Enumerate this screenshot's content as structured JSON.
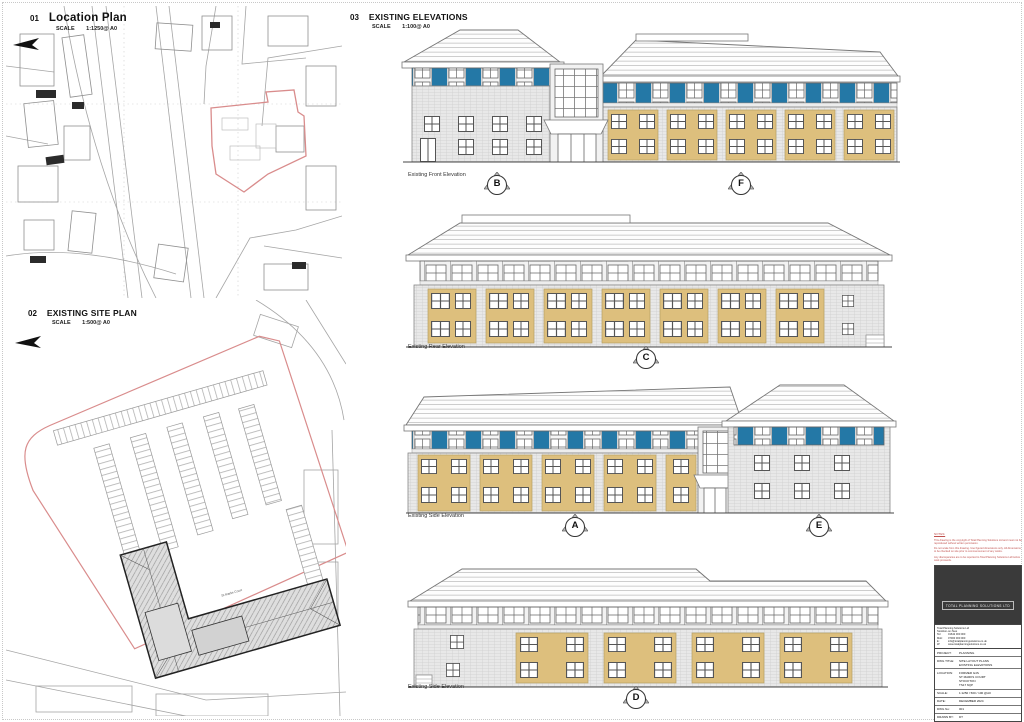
{
  "panels": {
    "location_plan": {
      "number": "01",
      "title": "Location Plan",
      "scale_label": "SCALE",
      "scale_value": "1:1250@ A0"
    },
    "site_plan": {
      "number": "02",
      "title": "EXISTING SITE PLAN",
      "scale_label": "SCALE",
      "scale_value": "1:500@ A0",
      "building_label": "St Marks Court"
    },
    "elevations": {
      "number": "03",
      "title": "EXISTING ELEVATIONS",
      "scale_label": "SCALE",
      "scale_value": "1:100@ A0",
      "items": [
        {
          "label": "Existing Front Elevation",
          "markers": [
            "B",
            "F"
          ]
        },
        {
          "label": "Existing Rear Elevation",
          "markers": [
            "C"
          ]
        },
        {
          "label": "Existing Side Elevation",
          "markers": [
            "A",
            "E"
          ]
        },
        {
          "label": "Existing Side Elevation",
          "markers": [
            "D"
          ]
        }
      ]
    }
  },
  "title_block": {
    "notes_heading": "NOTES:",
    "notes": [
      "This drawing is the copyright of Total Planning Solutions Ltd and must not be reproduced without written permission.",
      "Do not scale from this drawing. Use figured dimensions only. All dimensions to be checked on site prior to commencement of any works.",
      "Any discrepancies are to be reported to Total Planning Solutions Ltd before work proceeds."
    ],
    "company": "TOTAL PLANNING SOLUTIONS LTD",
    "contact": {
      "line1": "Total Planning Solutions Ltd",
      "line2": "Stockton-on-Tees",
      "tel_label": "Tel:",
      "tel": "01642 000 000",
      "mob_label": "Mob:",
      "mob": "07000 000 000",
      "email_label": "E:",
      "email": "info@totalplanningsolutions.co.uk",
      "web_label": "W:",
      "web": "www.totalplanningsolutions.co.uk"
    },
    "rows": {
      "project": {
        "label": "PROJECT:",
        "value": "PLANNING"
      },
      "dwg_title": {
        "label": "DWG TITLE:",
        "lines": [
          "SITE LAYOUT PLANS",
          "EXISTING ELEVATIONS"
        ]
      },
      "location": {
        "label": "LOCATION:",
        "lines": [
          "FORMER G4S",
          "ST MARKS COURT",
          "STOCKTON",
          "TS17 6QP"
        ]
      },
      "scale": {
        "label": "SCALE:",
        "value": "1:1250 / 500 / 100 @A0"
      },
      "date": {
        "label": "DATE:",
        "value": "DECEMBER 2024"
      },
      "dwg_no": {
        "label": "DWG No:",
        "value": "001"
      },
      "drawn_by": {
        "label": "DRAWN BY:",
        "value": "DT"
      }
    }
  },
  "colors": {
    "accent_blue": "#2478a6",
    "panel_tan": "#ddbf7d",
    "boundary_red": "#d98c8c",
    "wall_grey": "#e8e8e8",
    "logo_bg": "#3a3a3a",
    "note_red": "#c0504d"
  }
}
